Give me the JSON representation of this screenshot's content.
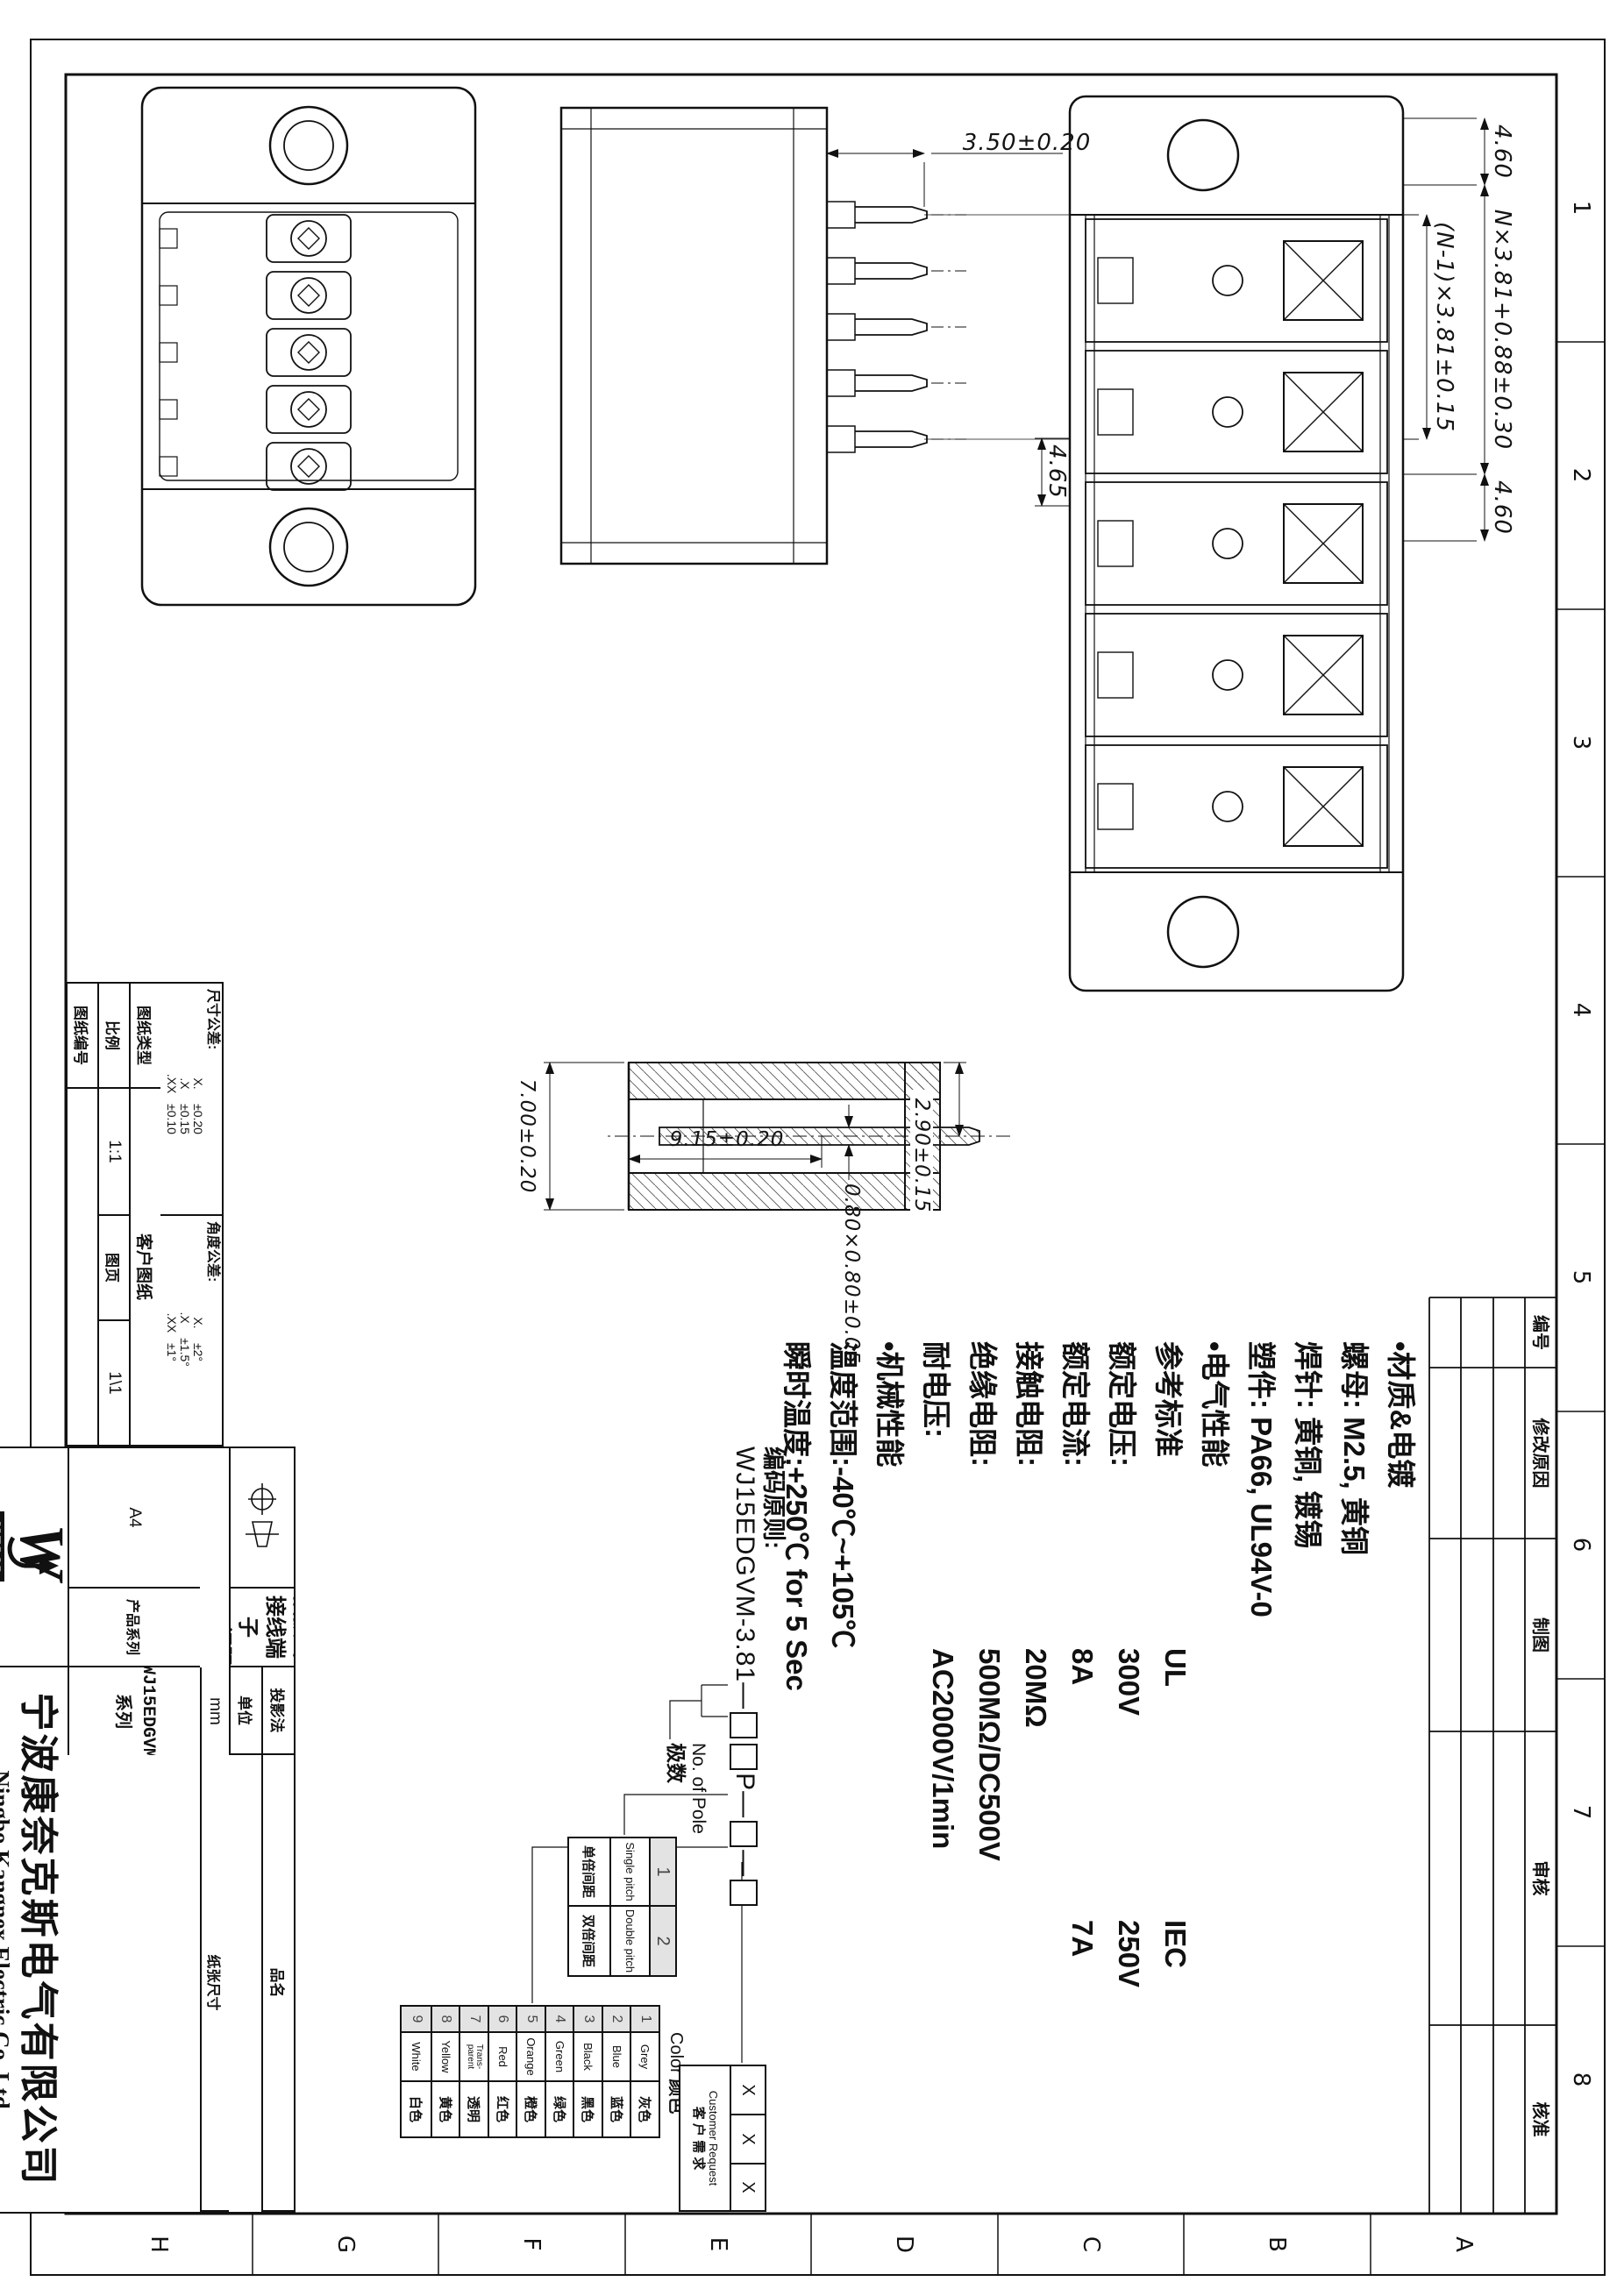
{
  "frame": {
    "grid_numbers": [
      "1",
      "2",
      "3",
      "4",
      "5",
      "6",
      "7",
      "8"
    ],
    "grid_letters": [
      "A",
      "B",
      "C",
      "D",
      "E",
      "F",
      "G",
      "H"
    ]
  },
  "revision_table": {
    "headers": [
      "编号",
      "修改原因",
      "制图",
      "审核",
      "核准"
    ]
  },
  "dims": {
    "d_460_a": "4.60",
    "d_n": "N×3.81+0.88±0.30",
    "d_460_b": "4.60",
    "d_n1": "(N-1)×3.81±0.15",
    "d_465": "4.65",
    "d_350": "3.50±0.20",
    "d_290": "2.90±0.15",
    "d_080": "0.80×0.80±0.05",
    "d_915": "9.15±0.20",
    "d_700": "7.00±0.20"
  },
  "specs": {
    "lines": [
      {
        "label": "•材质&电镀"
      },
      {
        "label": "螺母: M2.5, 黄铜"
      },
      {
        "label": "焊针: 黄铜, 镀锡"
      },
      {
        "label": "塑件: PA66, UL94V-0"
      },
      {
        "label": "•电气性能"
      },
      {
        "label": "参考标准",
        "v1": "UL",
        "v2": "IEC"
      },
      {
        "label": "额定电压:",
        "v1": "300V",
        "v2": "250V"
      },
      {
        "label": "额定电流:",
        "v1": "8A",
        "v2": "7A"
      },
      {
        "label": "接触电阻:",
        "v1": "20MΩ"
      },
      {
        "label": "绝缘电阻:",
        "v1": "500MΩ/DC500V"
      },
      {
        "label": "耐电压:",
        "v1": "AC2000V/1min"
      },
      {
        "label": "•机械性能"
      },
      {
        "label": "温度范围:-40℃~+105℃"
      },
      {
        "label": "瞬时温度:+250℃ for 5 Sec"
      }
    ]
  },
  "ordering": {
    "title": "编码原则:",
    "code": "WJ15EDGVM-3.81—",
    "p": "P",
    "dash": "—",
    "pole_label_en": "No. of Pole",
    "pole_label_cn": "极数",
    "pitch_table": [
      {
        "no": "1",
        "en": "Single pitch",
        "cn": "单倍间距"
      },
      {
        "no": "2",
        "en": "Double pitch",
        "cn": "双倍间距"
      }
    ],
    "color_label_en": "Color",
    "color_label_cn": "颜色",
    "color_table": [
      {
        "no": "1",
        "en": "Grey",
        "cn": "灰色"
      },
      {
        "no": "2",
        "en": "Blue",
        "cn": "蓝色"
      },
      {
        "no": "3",
        "en": "Black",
        "cn": "黑色"
      },
      {
        "no": "4",
        "en": "Green",
        "cn": "绿色"
      },
      {
        "no": "5",
        "en": "Orange",
        "cn": "橙色"
      },
      {
        "no": "6",
        "en": "Red",
        "cn": "红色"
      },
      {
        "no": "7",
        "en": "Trans-parent",
        "cn": "透明"
      },
      {
        "no": "8",
        "en": "Yellow",
        "cn": "黄色"
      },
      {
        "no": "9",
        "en": "White",
        "cn": "白色"
      }
    ],
    "customer": {
      "x1": "X",
      "x2": "X",
      "x3": "X",
      "en": "Customer Request",
      "cn": "客 户 需 求"
    }
  },
  "tolerance": {
    "dim_title": "尺寸公差:",
    "dim_rows": [
      [
        "X.",
        "±0.20"
      ],
      [
        ".X",
        "±0.15"
      ],
      [
        ".XX",
        "±0.10"
      ]
    ],
    "ang_title": "角度公差:",
    "ang_rows": [
      [
        "X.",
        "±2°"
      ],
      [
        ".X",
        "±1.5°"
      ],
      [
        ".XX",
        "±1°"
      ]
    ]
  },
  "info": {
    "type_label": "图纸类型",
    "type_value": "客户图纸",
    "scale_label": "比例",
    "scale_value": "1:1",
    "page_label": "图页",
    "page_value": "1\\1",
    "no_label": "图纸编号",
    "no_value": ""
  },
  "titleblock": {
    "projection_label": "投影法",
    "unit_label": "单位",
    "unit_value": "mm",
    "paper_label": "纸张尺寸",
    "paper_value": "A4",
    "series_label": "产品系列",
    "series_value": "WJ15EDGVM 系列",
    "name_label": "品名",
    "name_line1": "插拔式接线端子",
    "name_line2": "3.81间距"
  },
  "company": {
    "logo_text": "NZWJ",
    "logo_w": "W",
    "cn": "宁波康奈克斯电气有限公司",
    "en": "Ningbo Kangnex Electric Co.,Ltd"
  },
  "colors": {
    "line": "#111111",
    "paper": "#ffffff",
    "shaded_cell": "#e3e3e3"
  }
}
